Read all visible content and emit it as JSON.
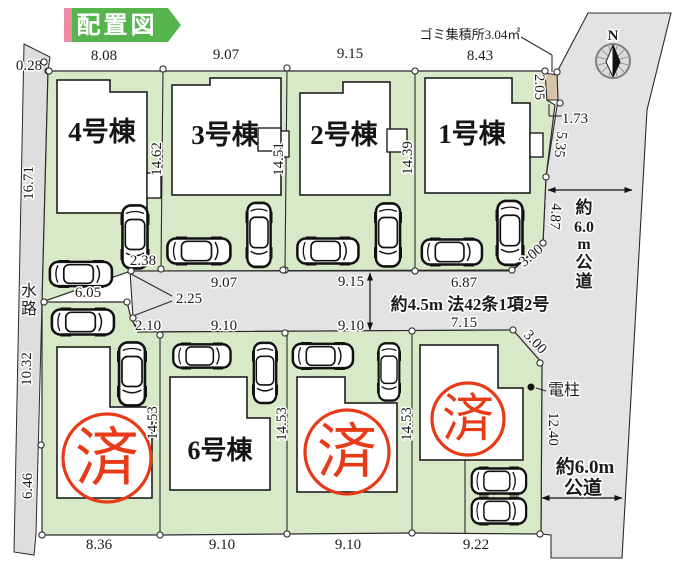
{
  "title": {
    "label": "配置図"
  },
  "compass": {
    "label": "N",
    "cx": 613,
    "cy": 61,
    "r": 17
  },
  "colors": {
    "green": "#d8e9c8",
    "road": "#e3e3e3",
    "water": "#dedede",
    "tan": "#d9c3aa",
    "stamp_red": "#e83a17",
    "title_green": "#55b44c",
    "title_pink": "#ef8aa4",
    "line": "#2b2b2b",
    "building_fill": "#ffffff"
  },
  "buildings": [
    {
      "name": "building-4",
      "label": "4号棟",
      "points": "57,80 110,80 110,92 147,92 147,213 57,213",
      "lx": 102,
      "ly": 141,
      "fs": 27
    },
    {
      "name": "building-3",
      "label": "3号棟",
      "points": "172,85 210,85 210,78 281,78 281,195 172,195",
      "lx": 225,
      "ly": 144,
      "fs": 27
    },
    {
      "name": "building-2",
      "label": "2号棟",
      "points": "300,93 343,93 343,82 390,82 390,195 300,195",
      "lx": 344,
      "ly": 144,
      "fs": 27
    },
    {
      "name": "building-1",
      "label": "1号棟",
      "points": "425,78 512,78 512,103 530,103 530,193 425,193",
      "lx": 472,
      "ly": 143,
      "fs": 27
    },
    {
      "name": "building-sold-a",
      "label": "",
      "points": "57,347 110,347 110,407 152,407 152,498 57,498"
    },
    {
      "name": "building-6",
      "label": "6号棟",
      "points": "170,377 247,377 247,418 270,418 270,490 170,490",
      "lx": 220,
      "ly": 459,
      "fs": 26
    },
    {
      "name": "building-sold-c",
      "label": "",
      "points": "297,377 345,377 345,403 397,403 397,492 297,492"
    },
    {
      "name": "building-sold-d",
      "label": "",
      "points": "420,345 498,345 498,388 523,388 523,460 420,460"
    }
  ],
  "bumps": [
    [
      147,
      173,
      14,
      25
    ],
    [
      258,
      128,
      23,
      23
    ],
    [
      281,
      131,
      8,
      26
    ],
    [
      387,
      129,
      20,
      23
    ],
    [
      530,
      133,
      13,
      24
    ]
  ],
  "stamps": [
    {
      "text": "済",
      "cx": 107,
      "cy": 458,
      "r": 44,
      "fs": 64
    },
    {
      "text": "済",
      "cx": 347,
      "cy": 452,
      "r": 42,
      "fs": 60
    },
    {
      "text": "済",
      "cx": 468,
      "cy": 419,
      "r": 36,
      "fs": 52
    }
  ],
  "cars": [
    {
      "cx": 199,
      "cy": 251,
      "rot": 0,
      "l": 66,
      "w": 29
    },
    {
      "cx": 328,
      "cy": 251,
      "rot": 0,
      "l": 64,
      "w": 29
    },
    {
      "cx": 452,
      "cy": 252,
      "rot": 0,
      "l": 63,
      "w": 29
    },
    {
      "cx": 81,
      "cy": 274,
      "rot": 0,
      "l": 65,
      "w": 28
    },
    {
      "cx": 83,
      "cy": 322,
      "rot": 0,
      "l": 65,
      "w": 29
    },
    {
      "cx": 202,
      "cy": 356,
      "rot": 0,
      "l": 60,
      "w": 27
    },
    {
      "cx": 323,
      "cy": 356,
      "rot": 0,
      "l": 63,
      "w": 28
    },
    {
      "cx": 499,
      "cy": 481,
      "rot": 0,
      "l": 57,
      "w": 29
    },
    {
      "cx": 499,
      "cy": 511,
      "rot": 0,
      "l": 57,
      "w": 29
    },
    {
      "cx": 135,
      "cy": 237,
      "rot": 90,
      "l": 66,
      "w": 29
    },
    {
      "cx": 259,
      "cy": 235,
      "rot": 90,
      "l": 67,
      "w": 27
    },
    {
      "cx": 388,
      "cy": 235,
      "rot": 90,
      "l": 66,
      "w": 28
    },
    {
      "cx": 510,
      "cy": 233,
      "rot": 90,
      "l": 67,
      "w": 29
    },
    {
      "cx": 132,
      "cy": 374,
      "rot": 90,
      "l": 66,
      "w": 30
    },
    {
      "cx": 265,
      "cy": 373,
      "rot": 90,
      "l": 63,
      "w": 26
    },
    {
      "cx": 389,
      "cy": 372,
      "rot": 90,
      "l": 60,
      "w": 24
    }
  ],
  "dimensions": [
    {
      "t": "0.28",
      "x": 29,
      "y": 70,
      "fs": 15
    },
    {
      "t": "8.08",
      "x": 104,
      "y": 60,
      "fs": 15
    },
    {
      "t": "9.07",
      "x": 226,
      "y": 59,
      "fs": 15
    },
    {
      "t": "9.15",
      "x": 350,
      "y": 58,
      "fs": 15
    },
    {
      "t": "8.43",
      "x": 480,
      "y": 60,
      "fs": 15
    },
    {
      "t": "ゴミ集積所3.04㎡",
      "x": 470,
      "y": 39,
      "fs": 13
    },
    {
      "t": "1.73",
      "x": 575,
      "y": 123,
      "fs": 15
    },
    {
      "t": "2.38",
      "x": 143,
      "y": 265,
      "fs": 15
    },
    {
      "t": "6.05",
      "x": 88,
      "y": 297,
      "fs": 15
    },
    {
      "t": "9.07",
      "x": 224,
      "y": 287,
      "fs": 15
    },
    {
      "t": "9.15",
      "x": 351,
      "y": 286,
      "fs": 15
    },
    {
      "t": "6.87",
      "x": 464,
      "y": 287,
      "fs": 15
    },
    {
      "t": "2.25",
      "x": 189,
      "y": 303,
      "fs": 15
    },
    {
      "t": "約4.5m 法42条1項2号",
      "x": 470,
      "y": 310,
      "fs": 17,
      "b": 1
    },
    {
      "t": "2.10",
      "x": 148,
      "y": 330,
      "fs": 15
    },
    {
      "t": "9.10",
      "x": 224,
      "y": 330,
      "fs": 15
    },
    {
      "t": "9.10",
      "x": 351,
      "y": 330,
      "fs": 15
    },
    {
      "t": "7.15",
      "x": 464,
      "y": 327,
      "fs": 15
    },
    {
      "t": "電柱",
      "x": 548,
      "y": 395,
      "fs": 16,
      "a": "s"
    },
    {
      "t": "8.36",
      "x": 99,
      "y": 549,
      "fs": 15
    },
    {
      "t": "9.10",
      "x": 222,
      "y": 549,
      "fs": 15
    },
    {
      "t": "9.10",
      "x": 348,
      "y": 549,
      "fs": 15
    },
    {
      "t": "9.22",
      "x": 476,
      "y": 549,
      "fs": 15
    },
    {
      "t": "16.71",
      "x": 33,
      "y": 183,
      "fs": 15,
      "r": -90
    },
    {
      "t": "10.32",
      "x": 31,
      "y": 369,
      "fs": 15,
      "r": -90
    },
    {
      "t": "6.46",
      "x": 32,
      "y": 486,
      "fs": 15,
      "r": -90
    },
    {
      "t": "14.62",
      "x": 161,
      "y": 159,
      "fs": 15,
      "r": -90
    },
    {
      "t": "14.51",
      "x": 283,
      "y": 159,
      "fs": 15,
      "r": -90
    },
    {
      "t": "14.39",
      "x": 412,
      "y": 158,
      "fs": 15,
      "r": -90
    },
    {
      "t": "14.53",
      "x": 157,
      "y": 423,
      "fs": 15,
      "r": -90
    },
    {
      "t": "14.53",
      "x": 286,
      "y": 424,
      "fs": 15,
      "r": -90
    },
    {
      "t": "14.53",
      "x": 411,
      "y": 424,
      "fs": 15,
      "r": -90
    },
    {
      "t": "2.05",
      "x": 535,
      "y": 87,
      "fs": 15,
      "r": 90
    },
    {
      "t": "5.35",
      "x": 556,
      "y": 144,
      "fs": 15,
      "r": 97
    },
    {
      "t": "4.87",
      "x": 551,
      "y": 216,
      "fs": 15,
      "r": 95
    },
    {
      "t": "12.40",
      "x": 549,
      "y": 429,
      "fs": 15,
      "r": 90
    },
    {
      "t": "3.00",
      "x": 534,
      "y": 259,
      "fs": 15,
      "r": -40
    },
    {
      "t": "3.00",
      "x": 532,
      "y": 345,
      "fs": 15,
      "r": 47
    },
    {
      "t": "水",
      "x": 29,
      "y": 296,
      "fs": 16
    },
    {
      "t": "路",
      "x": 29,
      "y": 314,
      "fs": 16
    },
    {
      "t": "約",
      "x": 584,
      "y": 213,
      "fs": 17,
      "b": 1
    },
    {
      "t": "6.0",
      "x": 584,
      "y": 232,
      "fs": 16,
      "b": 1
    },
    {
      "t": "m",
      "x": 584,
      "y": 249,
      "fs": 16,
      "b": 1
    },
    {
      "t": "公",
      "x": 584,
      "y": 268,
      "fs": 17,
      "b": 1
    },
    {
      "t": "道",
      "x": 584,
      "y": 287,
      "fs": 17,
      "b": 1
    },
    {
      "t": "約6.0m",
      "x": 585,
      "y": 473,
      "fs": 19,
      "b": 1
    },
    {
      "t": "公道",
      "x": 583,
      "y": 494,
      "fs": 19,
      "b": 1
    },
    {
      "t": "N",
      "x": 613,
      "y": 40,
      "fs": 15,
      "b": 1
    }
  ],
  "survey_points": [
    [
      48,
      71
    ],
    [
      163,
      69
    ],
    [
      161,
      269
    ],
    [
      287,
      68
    ],
    [
      285,
      270
    ],
    [
      415,
      71
    ],
    [
      415,
      271
    ],
    [
      545,
      71
    ],
    [
      557,
      72
    ],
    [
      560,
      103
    ],
    [
      546,
      177
    ],
    [
      543,
      243
    ],
    [
      512,
      270
    ],
    [
      131,
      271
    ],
    [
      283,
      270
    ],
    [
      127,
      302
    ],
    [
      44,
      302
    ],
    [
      133,
      318
    ],
    [
      160,
      335
    ],
    [
      285,
      333
    ],
    [
      412,
      331
    ],
    [
      513,
      330
    ],
    [
      540,
      363
    ],
    [
      41,
      445
    ],
    [
      42,
      535
    ],
    [
      160,
      535
    ],
    [
      287,
      534
    ],
    [
      412,
      533
    ],
    [
      540,
      534
    ],
    [
      44,
      62
    ],
    [
      49,
      71
    ]
  ],
  "lines": [
    [
      163,
      69,
      161,
      269
    ],
    [
      287,
      68,
      285,
      270
    ],
    [
      415,
      71,
      415,
      270
    ],
    [
      160,
      335,
      160,
      534
    ],
    [
      287,
      333,
      287,
      534
    ],
    [
      412,
      331,
      412,
      533
    ],
    [
      465,
      460,
      465,
      533
    ],
    [
      45,
      302,
      127,
      302
    ],
    [
      521,
      37,
      552,
      55
    ],
    [
      552,
      55,
      552,
      72
    ],
    [
      549,
      104,
      549,
      116
    ],
    [
      549,
      116,
      562,
      116
    ],
    [
      131,
      274,
      172,
      296
    ],
    [
      133,
      316,
      172,
      301
    ],
    [
      536,
      388,
      546,
      391
    ]
  ],
  "arrows": [
    [
      548,
      190,
      632,
      190
    ],
    [
      370,
      273,
      370,
      330
    ],
    [
      542,
      498,
      622,
      498
    ]
  ],
  "pole_dot": {
    "cx": 531,
    "cy": 387,
    "r": 3.5
  },
  "polygons": {
    "waterway": "24,44 50,57 48,71 42,302 36,534 34,555 14,552",
    "road": "588,13 671,13 647,110 622,558 551,558 551,535 541,534 542,363 513,330 138,332 133,318 130,271 512,271 543,243 546,177 558,100 557,72",
    "green_upper": "48,71 545,71 547,100 555,105 546,177 543,243 512,270 131,271 42,302",
    "green_lower": "42,302 127,302 131,318 138,332 513,330 542,363 541,534 412,533 160,535 42,535",
    "tan": "545,73 557,75 558,100 547,100"
  }
}
